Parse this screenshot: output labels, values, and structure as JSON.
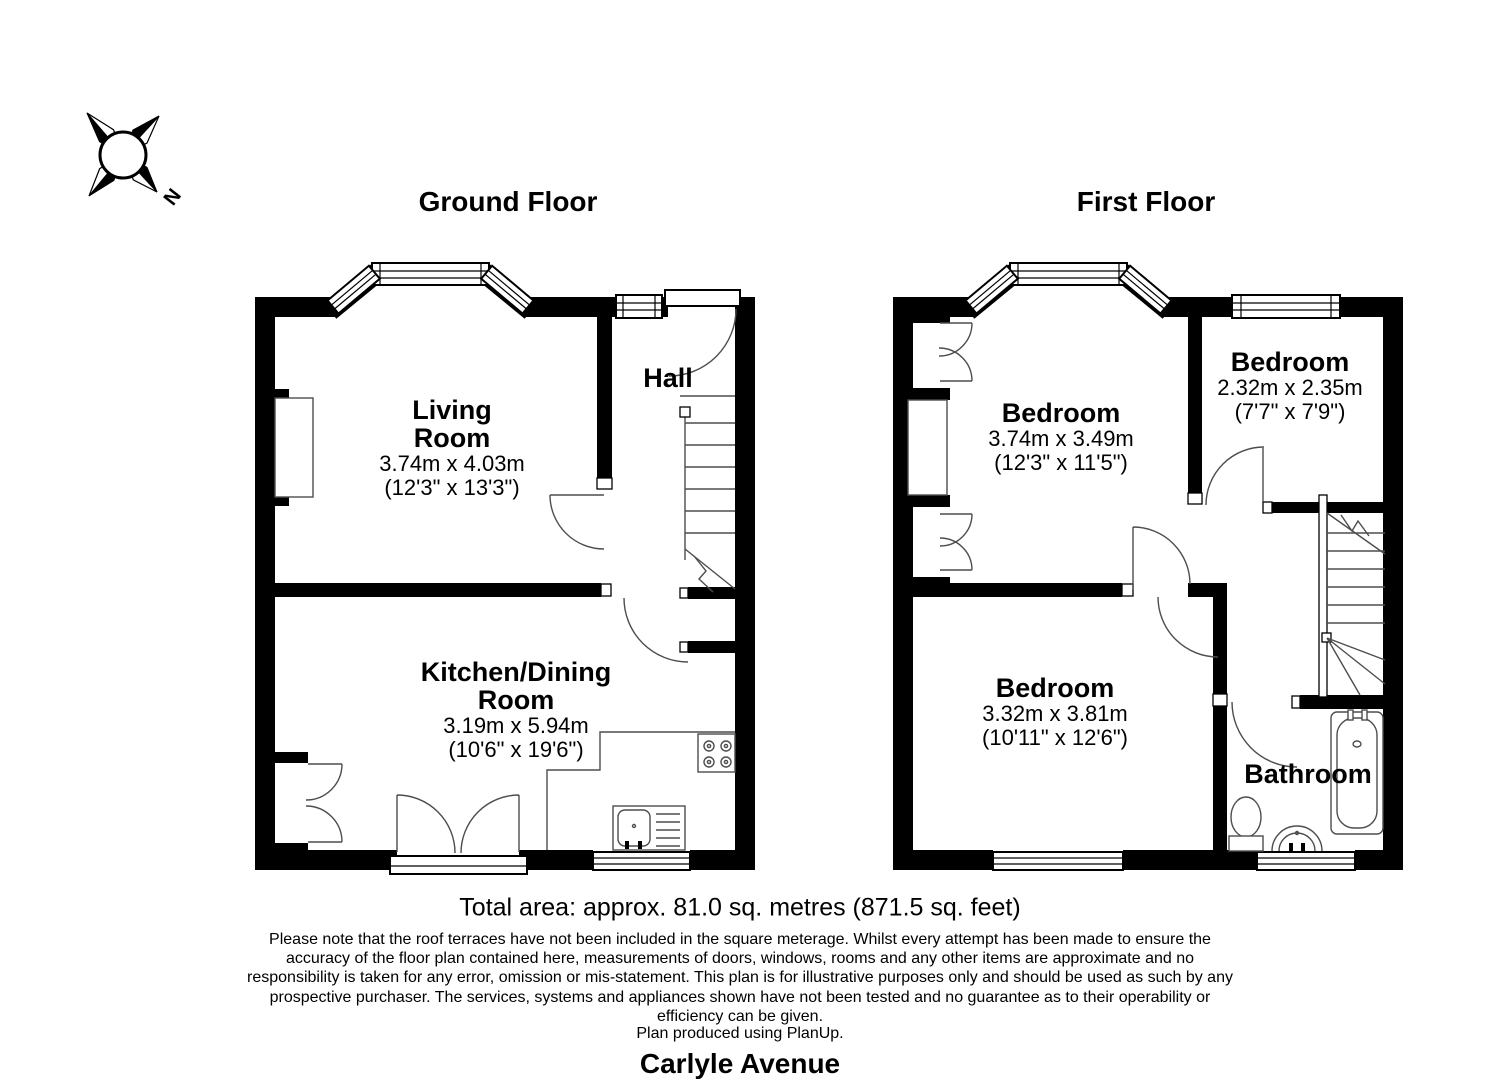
{
  "compass": {
    "north_label": "N"
  },
  "floors": [
    {
      "title": "Ground Floor",
      "rooms": [
        {
          "name_lines": [
            "Living",
            "Room"
          ],
          "metric": "3.74m x 4.03m",
          "imperial": "(12'3\" x 13'3\")"
        },
        {
          "name": "Hall"
        },
        {
          "name_lines": [
            "Kitchen/Dining",
            "Room"
          ],
          "metric": "3.19m x 5.94m",
          "imperial": "(10'6\" x 19'6\")"
        }
      ]
    },
    {
      "title": "First Floor",
      "rooms": [
        {
          "name": "Bedroom",
          "metric": "3.74m x 3.49m",
          "imperial": "(12'3\" x 11'5\")"
        },
        {
          "name": "Bedroom",
          "metric": "2.32m x 2.35m",
          "imperial": "(7'7\" x 7'9\")"
        },
        {
          "name": "Bedroom",
          "metric": "3.32m x 3.81m",
          "imperial": "(10'11\" x 12'6\")"
        },
        {
          "name": "Bathroom"
        }
      ]
    }
  ],
  "footer": {
    "total_area": "Total area: approx. 81.0 sq. metres (871.5 sq. feet)",
    "disclaimer_lines": [
      "Please note that the roof terraces have not been included in the square meterage. Whilst every attempt has been made to ensure the",
      "accuracy of the floor plan contained here, measurements of doors, windows, rooms and any other items are approximate and no",
      "responsibility is taken for any error, omission or mis-statement. This plan is for illustrative purposes only and should be used as such by any",
      "prospective purchaser. The services, systems and appliances shown have not been tested and no guarantee as to their operability or",
      "efficiency can be given."
    ],
    "produced": "Plan produced using PlanUp.",
    "address": "Carlyle Avenue"
  }
}
